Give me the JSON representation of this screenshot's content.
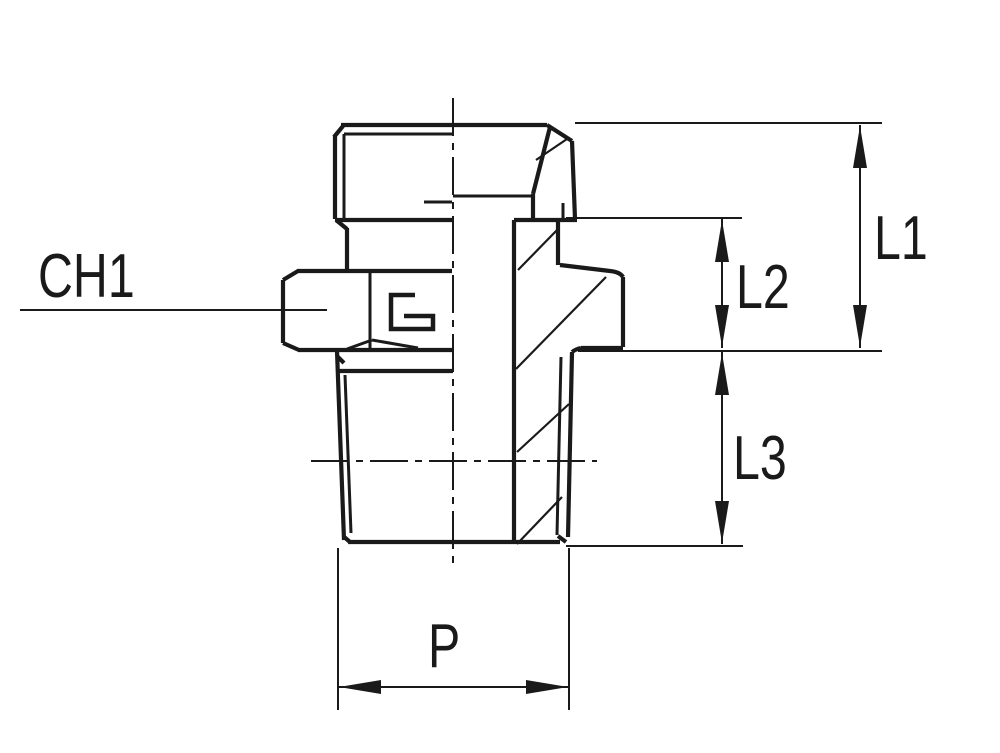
{
  "drawing": {
    "labels": {
      "ch1": "CH1",
      "l1": "L1",
      "l2": "L2",
      "l3": "L3",
      "p": "P"
    },
    "colors": {
      "background": "#ffffff",
      "line": "#1a1a1a"
    }
  }
}
